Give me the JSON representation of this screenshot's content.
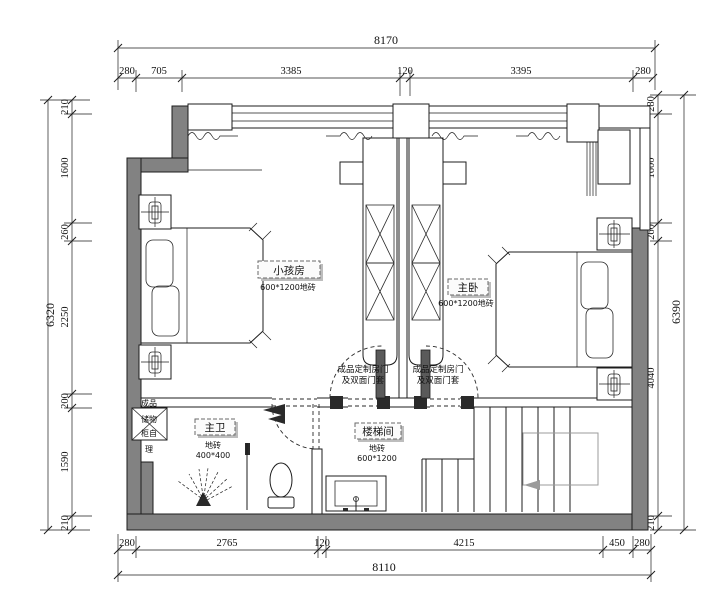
{
  "drawing": {
    "type": "floor-plan"
  },
  "dims": {
    "top_total": "8170",
    "top": [
      "280",
      "705",
      "3385",
      "120",
      "3395",
      "280"
    ],
    "bottom_total": "8110",
    "bottom": [
      "280",
      "2765",
      "120",
      "4215",
      "450",
      "280"
    ],
    "left_total": "6320",
    "left": [
      "210",
      "1600",
      "260",
      "2250",
      "200",
      "1590",
      "210"
    ],
    "right_total": "6390",
    "right": [
      "280",
      "1600",
      "260",
      "4040",
      "210"
    ]
  },
  "rooms": {
    "kids": {
      "name": "小孩房",
      "floor": "600*1200地砖"
    },
    "master": {
      "name": "主卧",
      "floor": "600*1200地砖"
    },
    "bath": {
      "name": "主卫",
      "floor_l1": "地砖",
      "floor_l2": "400*400"
    },
    "stair": {
      "name": "楼梯间",
      "floor_l1": "地砖",
      "floor_l2": "600*1200"
    }
  },
  "notes": {
    "door_left_l1": "成品定制房门",
    "door_left_l2": "及双面门套",
    "door_right_l1": "成品定制房门",
    "door_right_l2": "及双面门套",
    "cabinet_l1": "成品",
    "cabinet_l2": "储物",
    "cabinet_l3": "柜自",
    "cabinet_l4": "理"
  },
  "colors": {
    "wall": "#828282",
    "line": "#1c1c1c",
    "guide": "#9b9b9b"
  }
}
